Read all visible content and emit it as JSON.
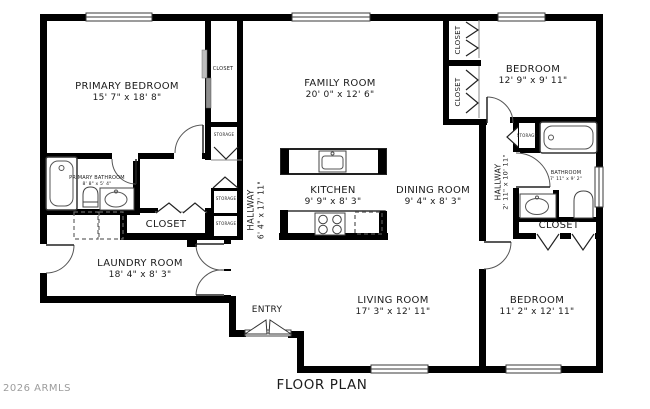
{
  "plan": {
    "title": "FLOOR PLAN",
    "watermark": "2026 ARMLS"
  },
  "rooms": {
    "primary_bedroom": {
      "name": "PRIMARY BEDROOM",
      "dims": "15' 7\" x 18' 8\""
    },
    "family_room": {
      "name": "FAMILY ROOM",
      "dims": "20' 0\" x 12' 6\""
    },
    "bedroom_top_right": {
      "name": "BEDROOM",
      "dims": "12' 9\" x 9' 11\""
    },
    "kitchen": {
      "name": "KITCHEN",
      "dims": "9' 9\" x 8' 3\""
    },
    "dining_room": {
      "name": "DINING ROOM",
      "dims": "9' 4\" x 8' 3\""
    },
    "hallway_main": {
      "name": "HALLWAY",
      "dims": "6' 4\" x 17' 11\""
    },
    "hallway_right": {
      "name": "HALLWAY",
      "dims": "2' 11\" x 10' 11\""
    },
    "primary_bathroom": {
      "name": "PRIMARY BATHROOM",
      "dims": "8' 8\" x 5' 4\""
    },
    "bathroom": {
      "name": "BATHROOM",
      "dims": "7' 11\" x 9' 2\""
    },
    "laundry_room": {
      "name": "LAUNDRY ROOM",
      "dims": "18' 4\" x 8' 3\""
    },
    "living_room": {
      "name": "LIVING ROOM",
      "dims": "17' 3\" x 12' 11\""
    },
    "bedroom_bottom_right": {
      "name": "BEDROOM",
      "dims": "11' 2\" x 12' 11\""
    },
    "entry": {
      "name": "ENTRY"
    }
  },
  "labels": {
    "closet": "CLOSET",
    "storage": "STORAGE"
  },
  "colors": {
    "wall": "#000000",
    "line": "#4c4c4c",
    "text": "#1b1b1b",
    "watermark": "#9c9c9c",
    "background": "#ffffff"
  }
}
